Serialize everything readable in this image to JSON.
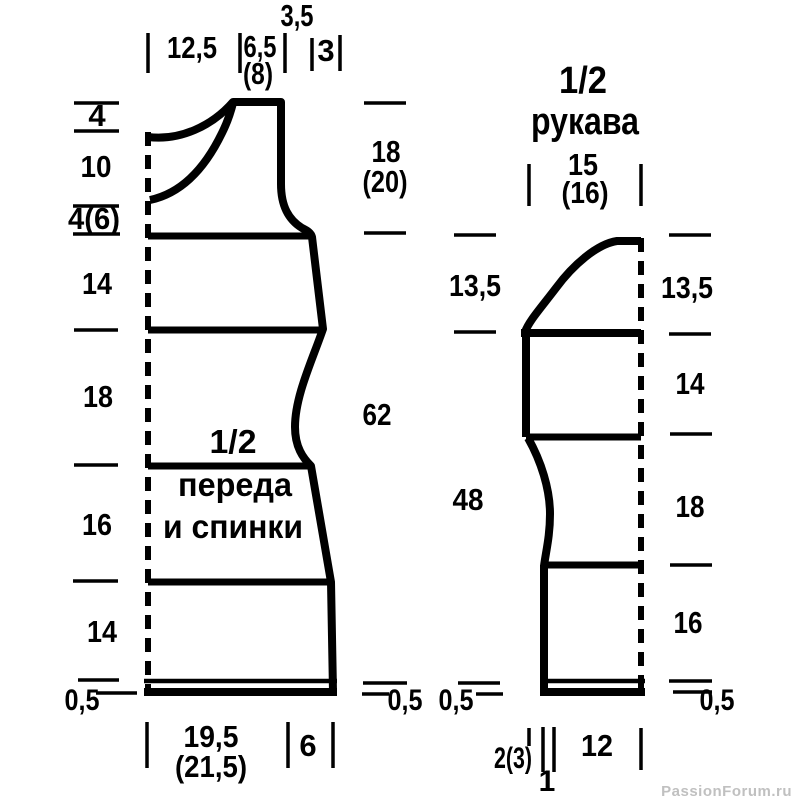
{
  "page": {
    "background": "#ffffff",
    "ink": "#000000",
    "watermark": "PassionForum.ru",
    "watermark_color": "#c0c0c0"
  },
  "body_piece": {
    "title": [
      "1/2",
      "переда",
      "и спинки"
    ],
    "top_edge": {
      "shoulder_width": "12,5",
      "neck_width": "6,5",
      "neck_width_alt": "(8)",
      "neck_slope": "3,5",
      "armhole_step": "3"
    },
    "left_edge": {
      "back_neck_drop": "4",
      "front_neck_drop": "10",
      "armhole_straight": "4(6)",
      "upper_side": "14",
      "waist_section": "18",
      "hip_section": "16",
      "lower_section": "14",
      "hem": "0,5"
    },
    "right_edge": {
      "armhole_depth": "18",
      "armhole_depth_alt": "(20)",
      "total_length": "62",
      "hem": "0,5"
    },
    "bottom_edge": {
      "half_width": "19,5",
      "half_width_alt": "(21,5)",
      "flare": "6"
    }
  },
  "sleeve_piece": {
    "title": [
      "1/2",
      "рукава"
    ],
    "top_edge": {
      "cap_width": "15",
      "cap_width_alt": "(16)"
    },
    "left_edge": {
      "cap_height": "13,5",
      "underarm_length": "48",
      "hem": "0,5"
    },
    "right_edge": {
      "cap_height": "13,5",
      "upper_section": "14",
      "mid_section": "18",
      "cuff_section": "16",
      "hem": "0,5"
    },
    "bottom_edge": {
      "decrease": "2(3)",
      "seam": "1",
      "cuff_width": "12"
    }
  }
}
